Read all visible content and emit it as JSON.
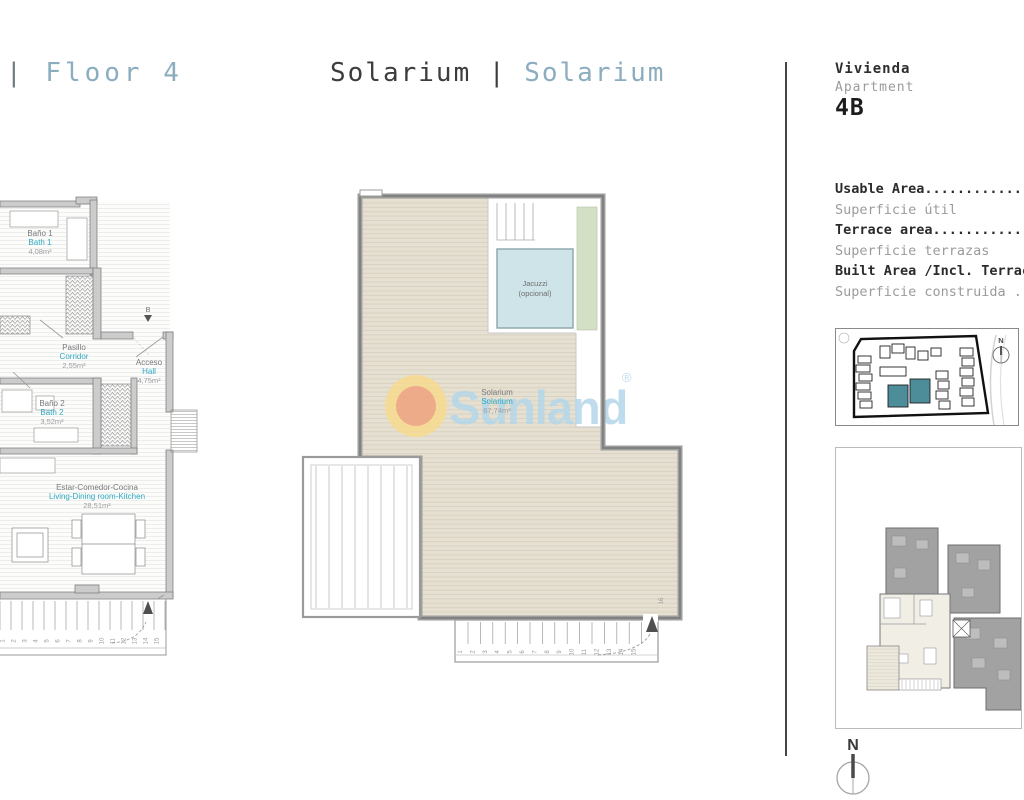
{
  "header": {
    "left_title": {
      "pipe": "|",
      "label": "Floor 4"
    },
    "center_title": {
      "primary": "Solarium",
      "pipe": "|",
      "secondary": "Solarium"
    }
  },
  "unit_panel": {
    "name_es": "Vivienda",
    "name_en": "Apartment",
    "unit_number": "4B",
    "areas": [
      {
        "en": "Usable Area......................",
        "es": "Superficie útil"
      },
      {
        "en": "Terrace area.....................",
        "es": "Superficie terrazas"
      },
      {
        "en": "Built Area /Incl. Terrace",
        "es": "Superficie construida ......"
      }
    ],
    "site_plan_north": "N",
    "compass_north": "N"
  },
  "left_plan": {
    "rooms": [
      {
        "name_es": "Baño 1",
        "name_en": "Bath 1",
        "area": "4,08m²"
      },
      {
        "name_es": "Pasillo",
        "name_en": "Corridor",
        "area": "2,55m²"
      },
      {
        "name_es": "Acceso",
        "name_en": "Hall",
        "area": "4,75m²"
      },
      {
        "name_es": "Baño 2",
        "name_en": "Bath 2",
        "area": "3,52m²"
      },
      {
        "name_es": "Estar-Comedor-Cocina",
        "name_en": "Living-Dining room-Kitchen",
        "area": "28,51m²"
      }
    ],
    "section_marker": "B",
    "stair_numbers": [
      "1",
      "2",
      "3",
      "4",
      "5",
      "6",
      "7",
      "8",
      "9",
      "10",
      "11",
      "12",
      "13",
      "14",
      "15"
    ]
  },
  "solarium_plan": {
    "room": {
      "name_es": "Solarium",
      "name_en": "Solarium",
      "area": "67,74m²"
    },
    "jacuzzi": {
      "line1": "Jacuzzi",
      "line2": "(opcional)"
    },
    "stair_numbers": [
      "1",
      "2",
      "3",
      "4",
      "5",
      "6",
      "7",
      "8",
      "9",
      "10",
      "11",
      "12",
      "13",
      "14",
      "15"
    ],
    "top_step": "16"
  },
  "watermark": {
    "text": "Sunland",
    "registered": "®"
  },
  "colors": {
    "title_accent": "#8badbf",
    "title_dark": "#3d3d3d",
    "label_cyan": "#2fa9c4",
    "label_gray": "#77797c",
    "area_gray": "#9c9ea0",
    "deck_beige": "#e6e0d2",
    "jacuzzi_blue": "#cfe4e9",
    "strip_green": "#d4e0c6",
    "site_highlight_teal": "#4c8d99",
    "watermark_blue": "#b3d7ea",
    "watermark_sun_outer": "#f7db8e",
    "watermark_sun_inner": "#f0a27e"
  }
}
